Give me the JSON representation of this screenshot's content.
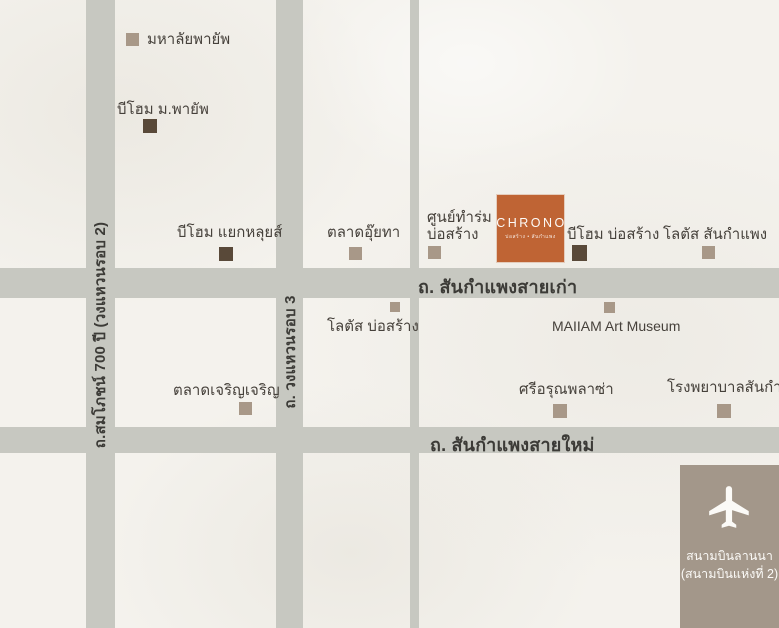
{
  "colors": {
    "background": "#f4f2ed",
    "road_gray": "#c7c8c1",
    "marker_tan": "#a89888",
    "marker_dark_brown": "#594939",
    "chrono_orange": "#bf6434",
    "airport_taupe": "#a3978a",
    "road_label_text": "#3c3b37",
    "landmark_text": "#46413b",
    "light_text": "#fbfaf7"
  },
  "roads": {
    "ring2": {
      "label": "ถ.สมโภชน์ 700 ปี (วงแหวนรอบ 2)"
    },
    "ring3": {
      "label": "ถ. วงแหวนรอบ 3"
    },
    "old_road": {
      "label": "ถ. สันกำแพงสายเก่า"
    },
    "new_road": {
      "label": "ถ. สันกำแพงสายใหม่"
    }
  },
  "chrono": {
    "title": "CHRONO",
    "subtitle": "บ่อสร้าง • สันกำแพง"
  },
  "airport": {
    "line1": "สนามบินลานนา",
    "line2": "(สนามบินแห่งที่ 2)",
    "icon": "airplane-icon"
  },
  "landmarks": [
    {
      "label": "มหาลัยพายัพ",
      "marker": "tan"
    },
    {
      "label": "บีโฮม ม.พายัพ",
      "marker": "dark"
    },
    {
      "label": "บีโฮม แยกหลุยส์",
      "marker": "dark"
    },
    {
      "label": "ตลาดอุ๊ยทา",
      "marker": "tan"
    },
    {
      "label": "ศูนย์ทำร่ม\nบ่อสร้าง",
      "marker": "tan"
    },
    {
      "label": "บีโฮม บ่อสร้าง",
      "marker": "dark"
    },
    {
      "label": "โลตัส สันกำแพง",
      "marker": "tan"
    },
    {
      "label": "โลตัส บ่อสร้าง",
      "marker": "tan"
    },
    {
      "label": "MAIIAM Art Museum",
      "marker": "tan"
    },
    {
      "label": "ตลาดเจริญเจริญ",
      "marker": "tan"
    },
    {
      "label": "ศรีอรุณพลาซ่า",
      "marker": "tan"
    },
    {
      "label": "โรงพยาบาลสันกำแพง",
      "marker": "tan"
    }
  ]
}
